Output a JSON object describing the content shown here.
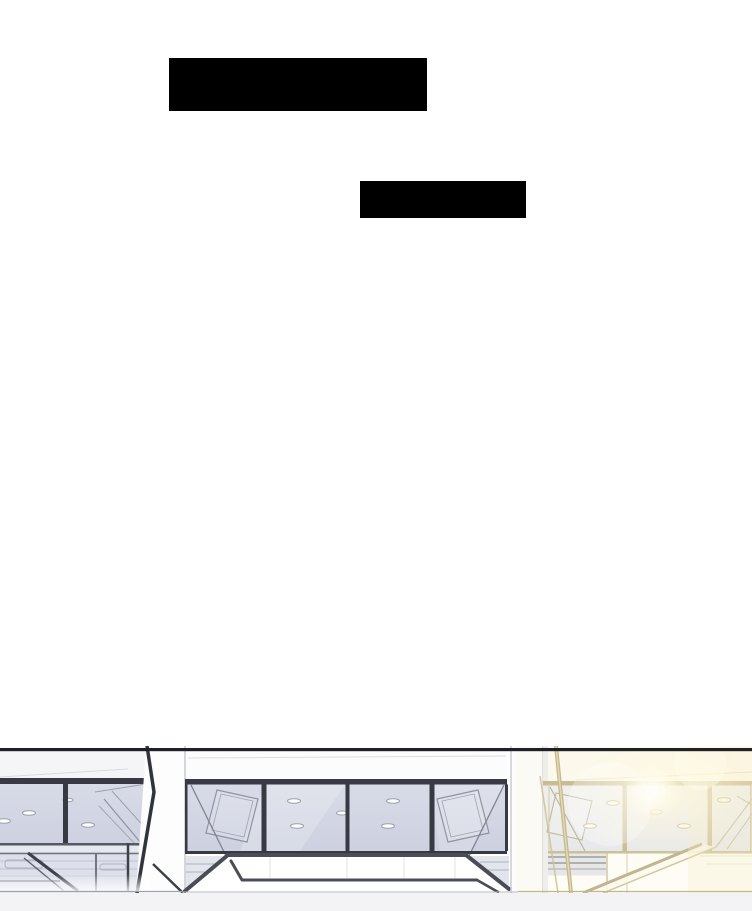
{
  "page": {
    "kind": "webtoon-comic-page",
    "width": 752,
    "height": 911,
    "background": "#ffffff"
  },
  "colors": {
    "page_bg": "#ffffff",
    "panel_border": "#1f2127",
    "mullion_dark": "#373a42",
    "glass_cool_top": "#d8dbe7",
    "glass_cool_bottom": "#cdd1e0",
    "glass_warm_top": "#ebeef6",
    "glass_warm_bottom": "#e1e5f1",
    "gold": "#b5a97b",
    "gold_line": "#b1a577",
    "glow": "#fff7dd",
    "wall_band": "#dde0ea",
    "beam_outline": "#4a4d55",
    "column_white": "#fdfdfe",
    "hairline_grey": "#c6c8ce",
    "footer": "#f3f3f6",
    "redaction": "#000000"
  },
  "redactions": {
    "bar1": {
      "left": 169,
      "top": 58,
      "width": 258,
      "height": 53,
      "color": "#000000"
    },
    "bar2": {
      "left": 360,
      "top": 181,
      "width": 166,
      "height": 37,
      "color": "#000000"
    }
  },
  "scene": {
    "label": "interior ceiling view: glass panels with recessed lights, two white columns, angular beam structure, warm sunlight flare on the right",
    "top": 746,
    "height": 165
  }
}
